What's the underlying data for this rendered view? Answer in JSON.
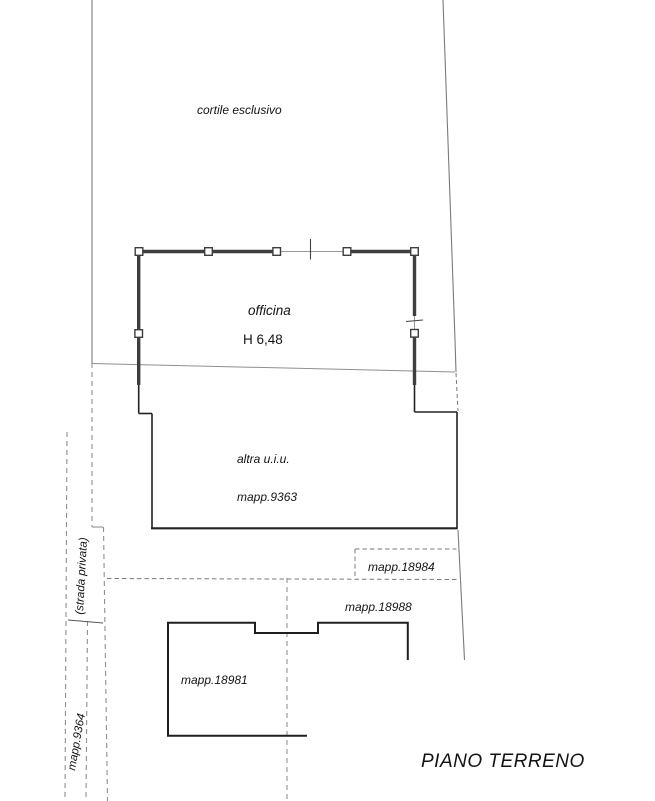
{
  "plan": {
    "title": "PIANO TERRENO",
    "labels": {
      "courtyard": "cortile esclusivo",
      "workshop": "officina",
      "workshop_height": "H 6,48",
      "other_unit_line1": "altra u.i.u.",
      "other_unit_line2": "mapp.9363",
      "parcel_18984": "mapp.18984",
      "parcel_18988": "mapp.18988",
      "parcel_18981": "mapp.18981",
      "private_road": "(strada privata)",
      "parcel_9364": "mapp.9364"
    },
    "colors": {
      "wall": "#3e3e3e",
      "building_outline": "#1f1f1f",
      "boundary_gray": "#8f8f8f",
      "dashed_gray": "#7a7a7a",
      "text": "#141414",
      "background": "#ffffff"
    }
  }
}
